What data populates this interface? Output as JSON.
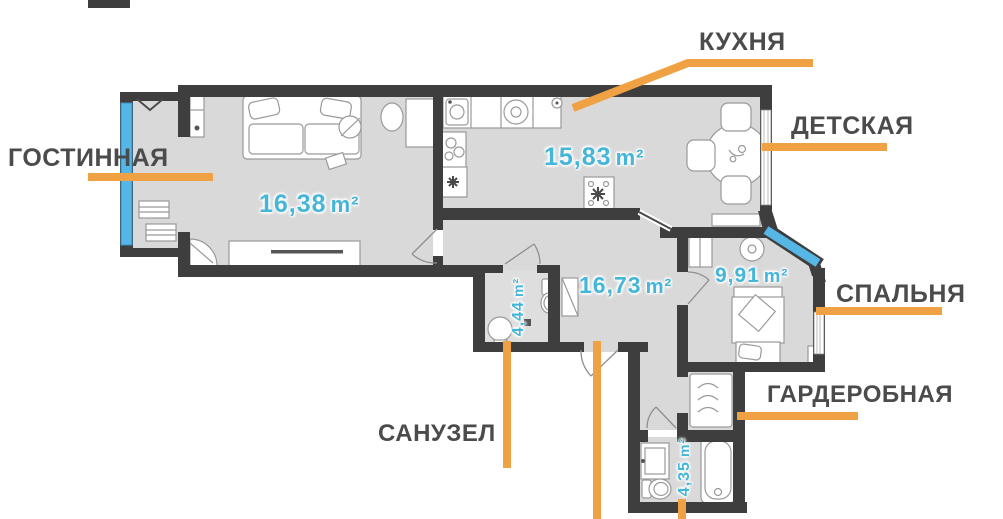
{
  "floorplan": {
    "room_callouts": {
      "kitchen": "КУХНЯ",
      "children": "ДЕТСКАЯ",
      "living": "ГОСТИННАЯ",
      "bedroom": "СПАЛЬНЯ",
      "wardrobe": "ГАРДЕРОБНАЯ",
      "bathroom": "САНУЗЕЛ"
    },
    "areas": {
      "living": {
        "value": "16,38",
        "unit": "m²"
      },
      "kitchen": {
        "value": "15,83",
        "unit": "m²"
      },
      "hallway": {
        "value": "16,73",
        "unit": "m²"
      },
      "bedroom": {
        "value": "9,91",
        "unit": "m²"
      },
      "bathroom_small": {
        "value": "4,44",
        "unit": "m²"
      },
      "bathroom_main": {
        "value": "4,35",
        "unit": "m²"
      }
    }
  },
  "colors": {
    "accent_orange": "#f0a144",
    "wall_dark": "#3e3e3e",
    "floor_gray": "#d9d9d9",
    "window_blue": "#56b6e6",
    "area_text_cyan": "#45b6d8",
    "label_text": "#4b4b4b"
  }
}
